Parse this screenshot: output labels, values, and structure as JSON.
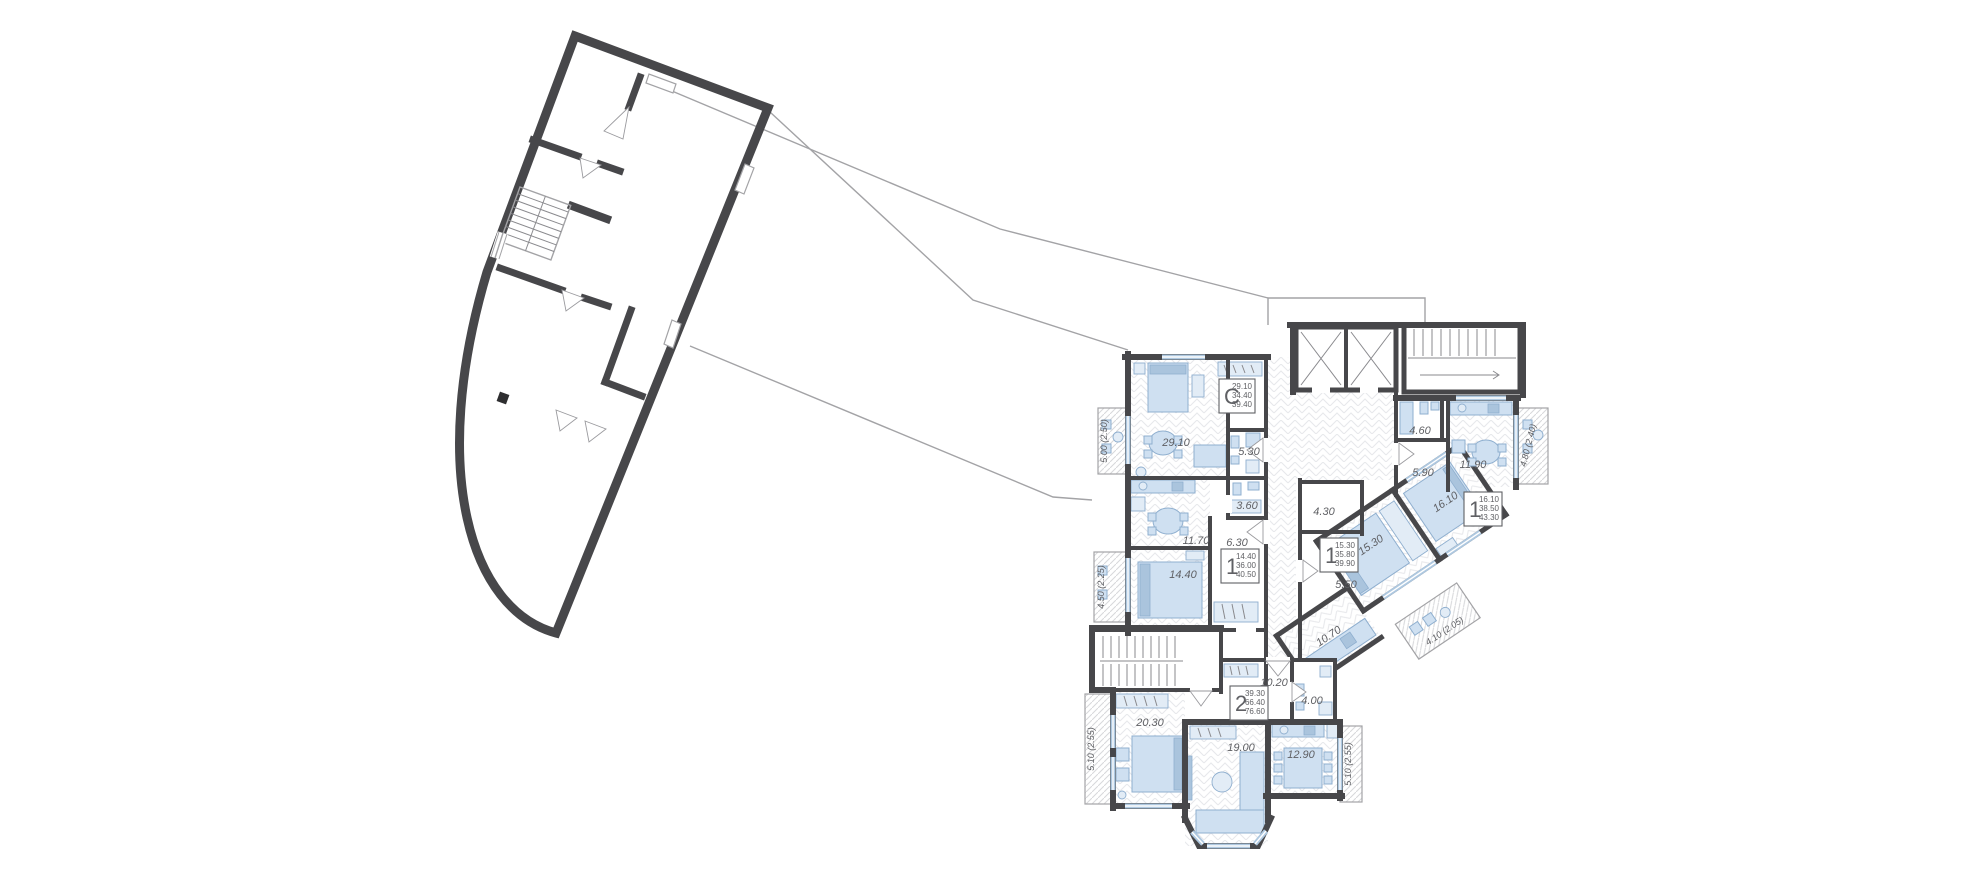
{
  "document": {
    "type": "residential-floor-plan",
    "background": "#ffffff"
  },
  "colors": {
    "walls": "#47474a",
    "furniture_fill": "#cfe0f1",
    "furniture_stroke": "#8fafcf",
    "window_blue": "#aec8e0",
    "label_text": "#5f6064",
    "outline_thin": "#a3a3a6"
  },
  "apartments": [
    {
      "label": "C",
      "values": [
        "29.10",
        "34.40",
        "39.40"
      ]
    },
    {
      "label": "1",
      "values": [
        "14.40",
        "36.00",
        "40.50"
      ]
    },
    {
      "label": "1",
      "values": [
        "15.30",
        "35.80",
        "39.90"
      ]
    },
    {
      "label": "1",
      "values": [
        "16.10",
        "38.50",
        "43.30"
      ]
    },
    {
      "label": "2",
      "values": [
        "39.30",
        "66.40",
        "76.60"
      ]
    }
  ],
  "rooms": {
    "studio_living": "29.10",
    "studio_bath": "5.30",
    "a1_kitchen": "11.70",
    "a1_hall": "6.30",
    "a1_bath": "3.60",
    "a1_bedroom": "14.40",
    "b1_bath": "4.30",
    "b1_living": "15.30",
    "b1_hall": "5.50",
    "b1_kitchen": "10.70",
    "c1_bath": "4.60",
    "c1_hall": "5.90",
    "c1_kitchen": "11.90",
    "c1_bedroom": "16.10",
    "a2_hall": "10.20",
    "a2_bath": "4.00",
    "a2_bedroom": "20.30",
    "a2_living": "19.00",
    "a2_kitchen": "12.90"
  },
  "balconies": {
    "studio": "5.00 (2.50)",
    "a1": "4.50 (2.25)",
    "a2_left": "5.10 (2.55)",
    "a2_right": "5.10 (2.55)",
    "c1": "4.80 (2.40)",
    "b1": "4.10 (2.05)"
  }
}
